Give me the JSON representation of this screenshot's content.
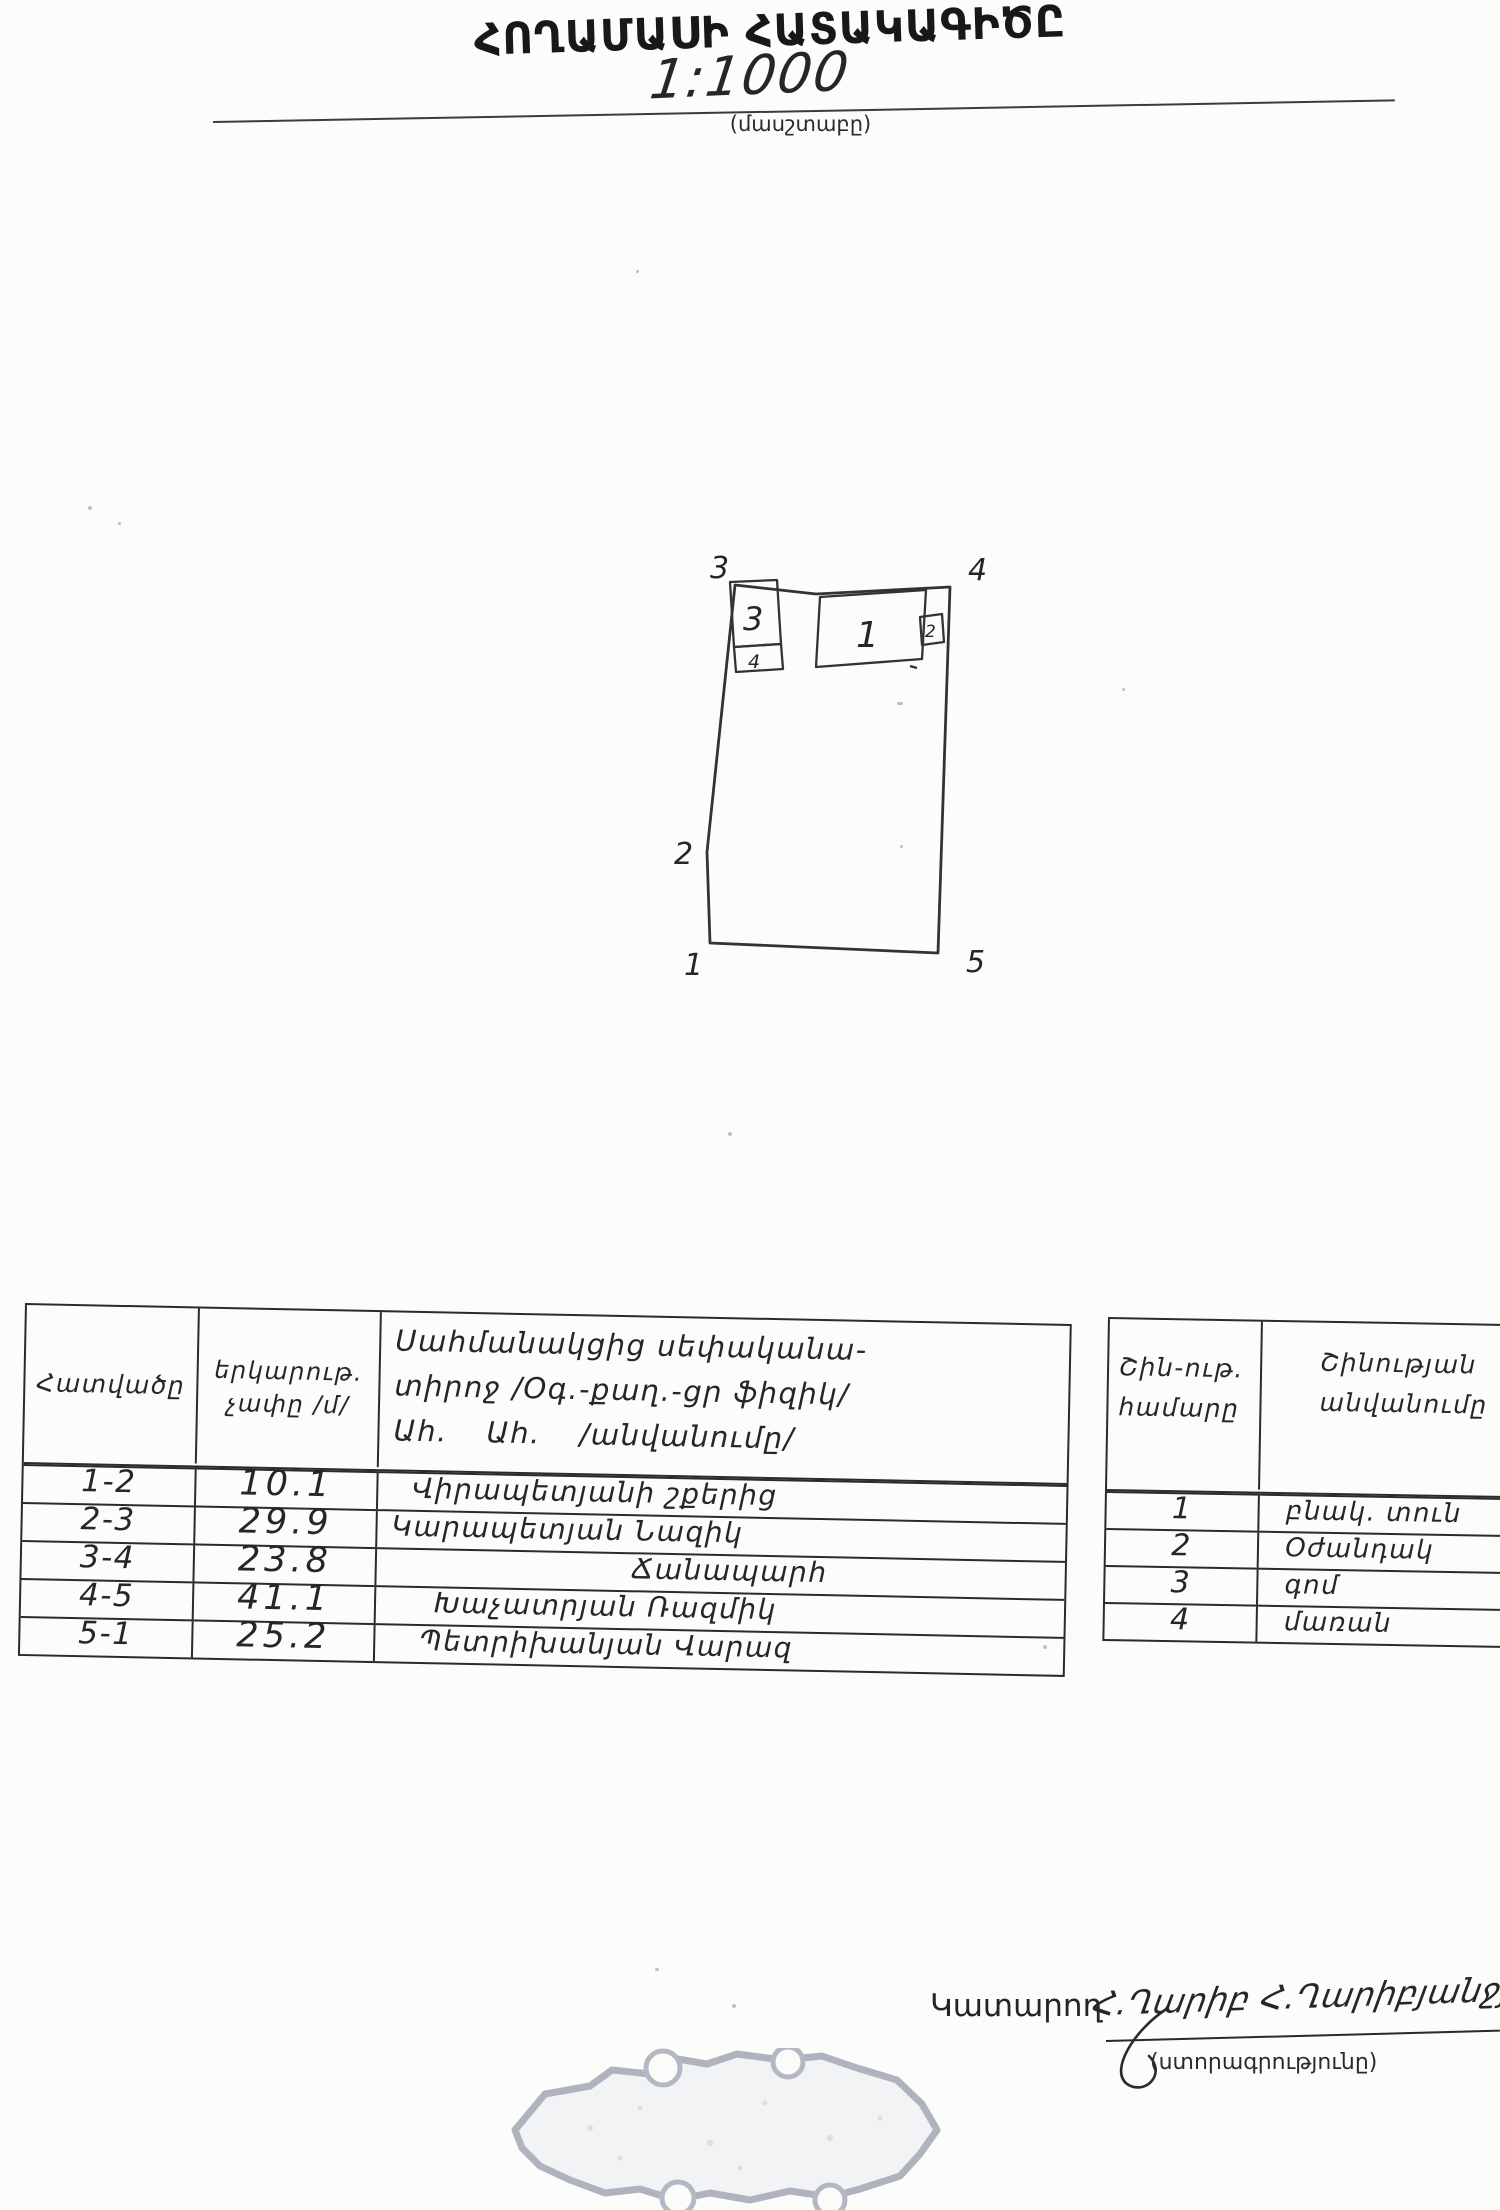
{
  "document": {
    "title": "ՀՈՂԱՄԱՍԻ ՀԱՏԱԿԱԳԻԾԸ",
    "scale": {
      "value": "1:1000",
      "caption": "(մասշտաբը)"
    }
  },
  "diagram": {
    "corner_points": {
      "p1": "1",
      "p2": "2",
      "p3": "3",
      "p4": "4",
      "p5": "5"
    },
    "buildings": {
      "b1": "1",
      "b2": "2",
      "b3": "3",
      "b4": "4"
    }
  },
  "segments_table": {
    "header": {
      "segment": "Հատվածը",
      "length_line1": "երկարութ.",
      "length_line2": "չափը /մ/",
      "neighbor_line1": "Սահմանակցից սեփականա-",
      "neighbor_line2": "տիրոջ /Օգ.-քաղ.-ցր ֆիզիկ/",
      "neighbor_line3": "Ահ. Ահ. /անվանումը/"
    },
    "rows": [
      {
        "segment": "1-2",
        "length": "10.1",
        "neighbor": "Վիրապետյանի շքերից"
      },
      {
        "segment": "2-3",
        "length": "29.9",
        "neighbor": "Կարապետյան Նազիկ"
      },
      {
        "segment": "3-4",
        "length": "23.8",
        "neighbor": "Ճանապարհ"
      },
      {
        "segment": "4-5",
        "length": "41.1",
        "neighbor": "Խաչատրյան Ռազմիկ"
      },
      {
        "segment": "5-1",
        "length": "25.2",
        "neighbor": "Պետրիխանյան Վարազ"
      }
    ]
  },
  "buildings_table": {
    "header": {
      "number_line1": "Շին-ութ.",
      "number_line2": "համարը",
      "name_line1": "Շինության",
      "name_line2": "անվանումը"
    },
    "rows": [
      {
        "number": "1",
        "name": "բնակ. տուն"
      },
      {
        "number": "2",
        "name": "Օժանդակ"
      },
      {
        "number": "3",
        "name": "գոմ"
      },
      {
        "number": "4",
        "name": "մառան"
      }
    ]
  },
  "footer": {
    "executor_label": "Կատարող",
    "signature_script": "Հ.Ղարիբ Հ.Ղարիբյանջյան",
    "signature_caption": "(ստորագրությունը)"
  },
  "colors": {
    "ink": "#2b2b2b",
    "paper": "#fcfcfb",
    "stamp_border": "#a6acb7"
  }
}
